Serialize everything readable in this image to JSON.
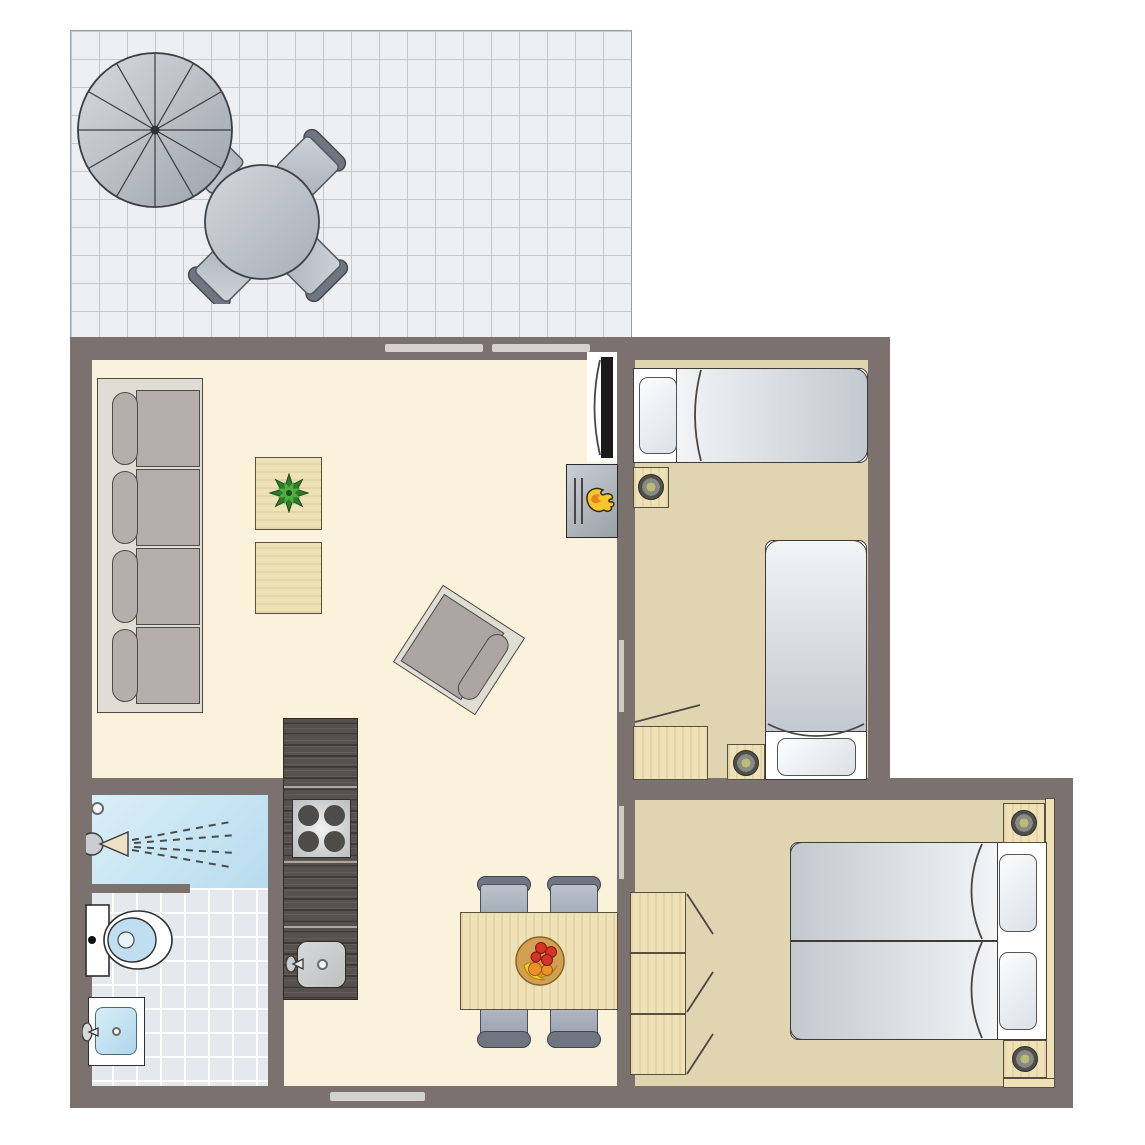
{
  "scene": {
    "type": "floor-plan",
    "name": "holiday-apartment-top-view",
    "rooms": [
      {
        "name": "terrace",
        "floor": "tile-grid",
        "furniture": [
          "parasol-12-segments",
          "round-table",
          "chair",
          "chair",
          "chair",
          "chair"
        ]
      },
      {
        "name": "living-room-kitchen",
        "floor": "cream",
        "furniture": [
          "sofa-4-seats",
          "coffee-table-with-plant",
          "coffee-table",
          "armchair-rotated",
          "tv-flatscreen",
          "wood-stove-fireplace",
          "kitchen-counter",
          "stove-4-burners",
          "kitchen-sink",
          "dining-table",
          "dining-chair",
          "dining-chair",
          "dining-chair",
          "dining-chair",
          "fruit-bowl"
        ]
      },
      {
        "name": "bathroom",
        "floor": "tile",
        "furniture": [
          "shower-with-spray",
          "floor-drain",
          "toilet",
          "washbasin"
        ]
      },
      {
        "name": "bedroom-1",
        "floor": "tan",
        "furniture": [
          "single-bed-horizontal",
          "single-bed-vertical",
          "nightstand-lamp",
          "nightstand-lamp",
          "low-cabinet"
        ]
      },
      {
        "name": "bedroom-2",
        "floor": "tan",
        "furniture": [
          "double-bed-two-mattresses",
          "pillow",
          "pillow",
          "nightstand-lamp",
          "nightstand-lamp",
          "wardrobe-3-doors",
          "headboard-panel"
        ]
      }
    ],
    "openings": {
      "top-wall-windows": 2,
      "bottom-wall-windows": 1,
      "sliding-doors": 2
    },
    "counts": {
      "beds": 3,
      "lamps": 4,
      "dining-chairs": 4,
      "terrace-chairs": 4
    }
  },
  "colors": {
    "wall": "#7B7270",
    "outline": "#3E3B38",
    "floor-living": "#FBF2DC",
    "floor-bedroom": "#E1D5B1",
    "terrace-tile": "#EDEFF2",
    "terrace-grid": "#C4C9D0",
    "bath-tile": "#E5E9EE",
    "bath-grid": "#FFFFFF",
    "shower-a": "#DCF0F9",
    "shower-b": "#B7DCEF",
    "wood": "#F0E2B8",
    "wood-edge": "#57503F",
    "counter": "#57504C",
    "counter-line": "#ABA6A1",
    "furn-gray": "#B5AEAB",
    "furn-gray-dark": "#4F4A47",
    "frame-light": "#E0DDD4",
    "mattress-a": "#F2F4F6",
    "mattress-b": "#C3C9D0",
    "pillow-a": "#FCFDFE",
    "pillow-b": "#DCE1E6",
    "chair-seat-a": "#BCC3CE",
    "chair-seat-b": "#98A1AE",
    "chair-back": "#6F7681",
    "tv-black": "#1A1A1A",
    "window-strip": "#D5D1CD",
    "door-strip": "#CFCBC7",
    "flame-yellow": "#F7C52E",
    "flame-orange": "#E8861E",
    "plant-dark": "#2F7A2B",
    "plant-light": "#4CAF3E",
    "apple-red": "#D63426",
    "banana-yellow": "#F2CB33",
    "orange-fruit": "#EC9126",
    "bowl-tan": "#D2A055",
    "lamp-outer": "#4F4F4B",
    "lamp-mid": "#8A8A84",
    "lamp-center": "#B9BC74"
  }
}
